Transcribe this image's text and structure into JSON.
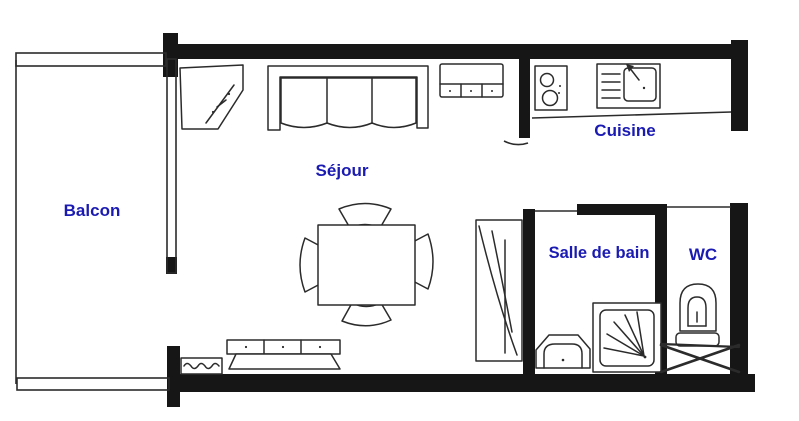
{
  "document": {
    "type": "floor-plan",
    "language": "fr"
  },
  "colors": {
    "room_label_blue": "#1b1bb3",
    "wall_black": "#161616",
    "furniture_line": "#2b2b2b",
    "background": "#ffffff"
  },
  "rooms": [
    {
      "id": "balcon",
      "label": "Balcon"
    },
    {
      "id": "sejour",
      "label": "Séjour"
    },
    {
      "id": "cuisine",
      "label": "Cuisine"
    },
    {
      "id": "salle_de_bain",
      "label": "Salle de bain"
    },
    {
      "id": "wc",
      "label": "WC"
    }
  ],
  "furniture": [
    {
      "id": "corner-unit",
      "room": "sejour"
    },
    {
      "id": "sofa",
      "room": "sejour"
    },
    {
      "id": "low-cabinet",
      "room": "sejour"
    },
    {
      "id": "dining-table",
      "room": "sejour"
    },
    {
      "id": "chairs",
      "room": "sejour",
      "count": 4
    },
    {
      "id": "sideboard",
      "room": "sejour"
    },
    {
      "id": "radiator",
      "room": "sejour"
    },
    {
      "id": "wardrobe",
      "room": "sejour"
    },
    {
      "id": "hob",
      "room": "cuisine"
    },
    {
      "id": "sink-unit",
      "room": "cuisine"
    },
    {
      "id": "washbasin",
      "room": "salle_de_bain"
    },
    {
      "id": "shower",
      "room": "salle_de_bain"
    },
    {
      "id": "toilet",
      "room": "wc"
    },
    {
      "id": "duct",
      "room": "wc"
    }
  ]
}
